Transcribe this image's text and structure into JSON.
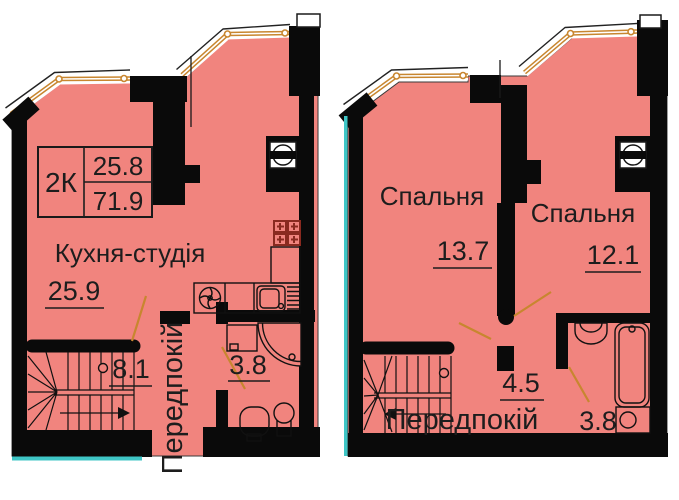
{
  "left_plan": {
    "unit_type": "2К",
    "level_area": "25.8",
    "total_area": "71.9",
    "kitchen_label": "Кухня-студія",
    "kitchen_area": "25.9",
    "stairs_hall_area": "8.1",
    "hallway_label": "Передпокій",
    "bathroom_area": "3.8"
  },
  "right_plan": {
    "bedroom1_label": "Спальня",
    "bedroom1_area": "13.7",
    "bedroom2_label": "Спальня",
    "bedroom2_area": "12.1",
    "hallway_area": "4.5",
    "hallway_label": "Передпокій",
    "bathroom_area": "3.8"
  },
  "colors": {
    "floor_fill": "#F1847E",
    "wall": "#0a0a0a",
    "window_frame": "#C8862F",
    "accent_teal": "#3FC6C6",
    "fixture_maroon": "#8a2a20",
    "text": "#1d1d1d"
  },
  "icons": {
    "vent": "vent-shaft-icon",
    "stove": "stove-burners-icon",
    "kitchen_sink": "kitchen-sink-icon",
    "hob_fan": "hob-fan-icon",
    "shower": "corner-shower-icon",
    "toilet": "toilet-icon",
    "washbasin": "washbasin-icon",
    "bathtub": "bathtub-icon",
    "washer": "washing-machine-icon",
    "stairs": "winder-stairs-icon"
  }
}
